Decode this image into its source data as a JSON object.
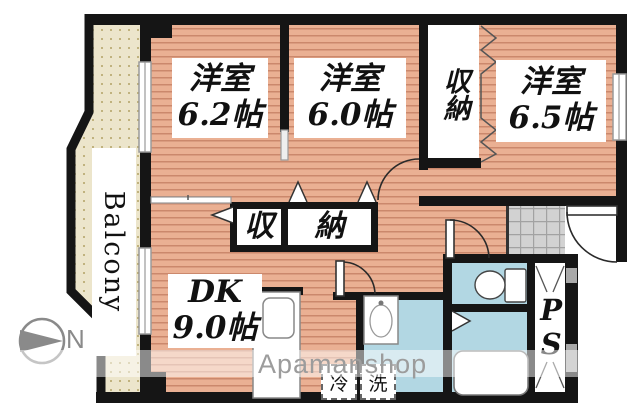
{
  "fp": {
    "rooms": [
      {
        "name": "洋室",
        "size": "6.2帖"
      },
      {
        "name": "洋室",
        "size": "6.0帖"
      },
      {
        "name": "洋室",
        "size": "6.5帖"
      }
    ],
    "dk": {
      "name": "DK",
      "size": "9.0帖"
    },
    "closet_upper": "収納",
    "closet_center_left": "収",
    "closet_center_right": "納",
    "balcony": "Balcony",
    "ps": "PS",
    "fridge": "冷",
    "washer": "洗",
    "north": "N",
    "watermark": "Apamanshop"
  },
  "colors": {
    "wall": "#151515",
    "wood_base": "#eab093",
    "wood_stripe": "#c07a5e",
    "balcony_base": "#ece5cb",
    "balcony_dot": "#b3a265",
    "wet_area": "#b2d7e3",
    "tile": "#d2d2d2",
    "label_text": "#111111",
    "watermark": "#9c9c9c",
    "compass": "#8a8a8a"
  }
}
